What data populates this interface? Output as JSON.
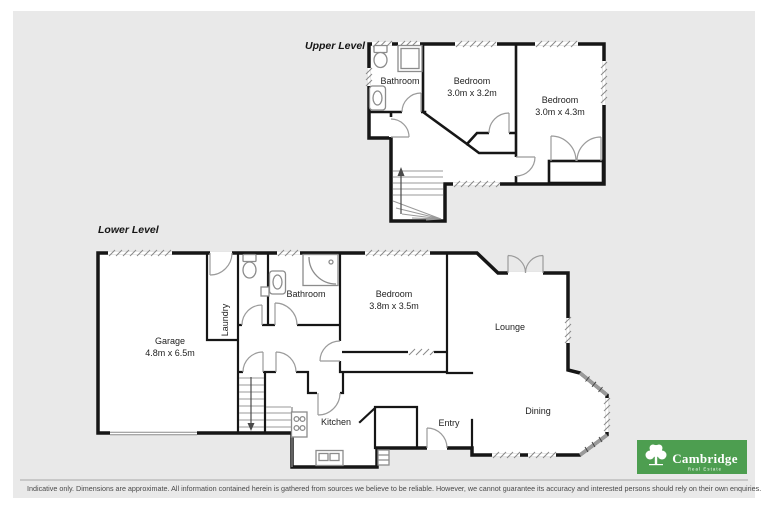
{
  "colors": {
    "panel_bg": "#e9e9e9",
    "wall": "#161616",
    "logo_green": "#4d9e50",
    "logo_text": "#ffffff",
    "footer_text_color": "#4a4a4a"
  },
  "upper_level": {
    "title": "Upper Level",
    "bathroom": "Bathroom",
    "bedroom1": {
      "name": "Bedroom",
      "dims": "3.0m x 3.2m"
    },
    "bedroom2": {
      "name": "Bedroom",
      "dims": "3.0m x 4.3m"
    }
  },
  "lower_level": {
    "title": "Lower Level",
    "garage": {
      "name": "Garage",
      "dims": "4.8m x 6.5m"
    },
    "laundry": "Laundry",
    "bathroom": "Bathroom",
    "bedroom": {
      "name": "Bedroom",
      "dims": "3.8m x 3.5m"
    },
    "lounge": "Lounge",
    "entry": "Entry",
    "kitchen": "Kitchen",
    "dining": "Dining"
  },
  "branding": {
    "name": "Cambridge",
    "tagline": "Real Estate"
  },
  "footer": {
    "disclaimer": "Indicative only. Dimensions are approximate. All information contained herein is gathered from sources we believe to be reliable. However, we cannot guarantee its accuracy and interested persons should rely on their own enquiries."
  }
}
